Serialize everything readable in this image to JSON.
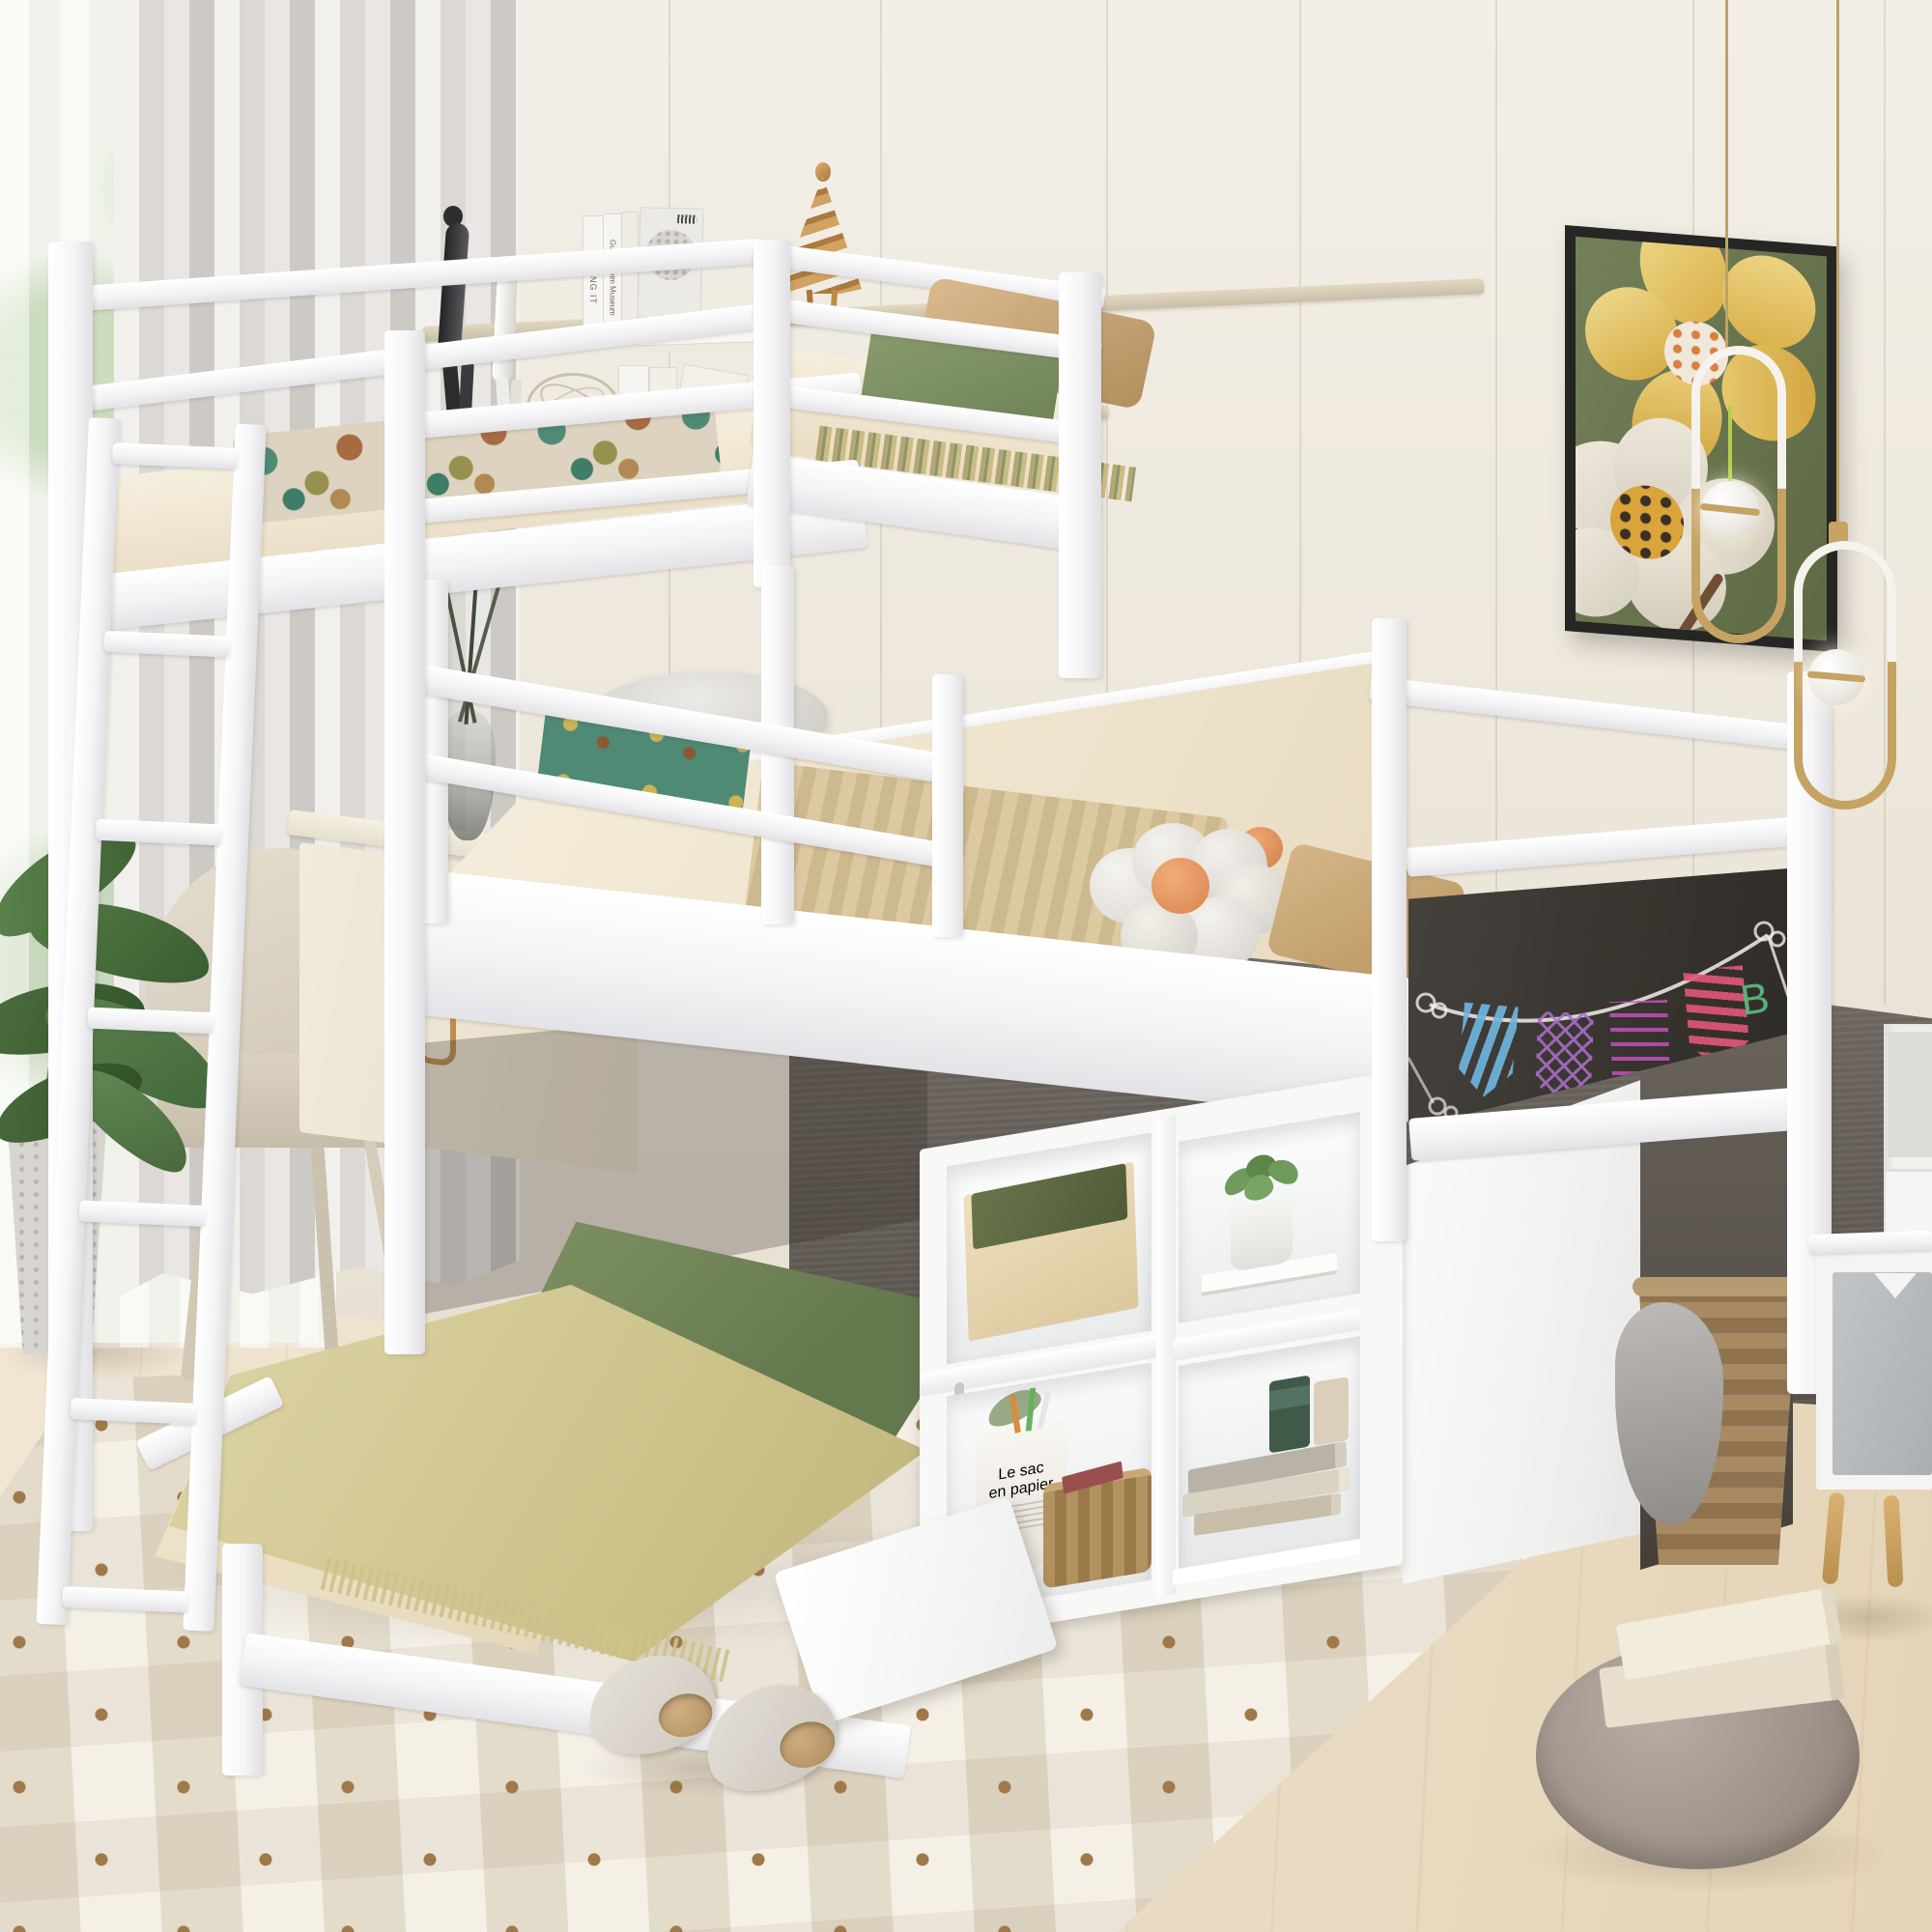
{
  "scene": {
    "type": "furniture product photograph",
    "subject": "White wood L-shaped triple bunk bed (twin-over-twin-over-twin) with ladder, storage cubby shelves, chalkboard panel, drop-down desk panel and under-loft nook",
    "room": "kids bedroom with cream panel walls, gray wood wainscot, light wood floor and patterned rug"
  },
  "texts": {
    "making_it": "MAKING IT",
    "guggenheim": "Guggenheim Museum",
    "lower_book": "IT",
    "bucket_line1": "Le sac",
    "bucket_line2": "en papier",
    "chalk_letter": "B"
  },
  "palette": {
    "bed_frame_white": "#fbfbfc",
    "wall_cream": "#efeae0",
    "wainscot_gray": "#6b655e",
    "floor_wood": "#ead9c0",
    "rug_beige": "#eae3d4",
    "rug_diamond_brown": "#a0794a",
    "mattress_cream": "#f3ebd9",
    "blanket_green": "#6d8157",
    "throw_yellow_green": "#d5cd9c",
    "pillow_tan": "#cdab7e",
    "flower_pillow_center_orange": "#e89a64",
    "chalkboard_dark": "#3c3935",
    "chalk_blue": "#6fb3dd",
    "chalk_purple": "#aa6ec8",
    "chalk_magenta": "#c850be",
    "chalk_pink": "#e05577",
    "chalk_green": "#5dbd82",
    "painting_bg_green": "#6e7b53",
    "painting_flower_yellow": "#e2bd5e",
    "pendant_gold": "#c2a06a",
    "curtain_gray_white": "#e6e3e0",
    "pouf_gray": "#a79b92",
    "nightstand_door_gray": "#b7babd",
    "wicker_tan": "#a98a5f"
  },
  "objects": [
    {
      "label": "triple bunk bed frame, white wood"
    },
    {
      "label": "top bunk with cream bedding, patterned blanket, green blanket, two tan pillows"
    },
    {
      "label": "middle loft bed with woven tan blanket, teal cloth, flower-shaped pillow with orange center, tan pillows"
    },
    {
      "label": "bottom bed with beige sheet, dark green blanket, fringed yellow-green throw"
    },
    {
      "label": "white ladder with seven rungs"
    },
    {
      "label": "chalkboard side panel with chalk banner garland drawing"
    },
    {
      "label": "storage cubbies with box, fabric bucket, wicker basket, succulent, books, candles"
    },
    {
      "label": "drop-down white desk panel"
    },
    {
      "label": "under-loft nook with wicker laundry basket and gray cloth"
    },
    {
      "label": "wall shelf with books, black and white sitting figurines, bronze spiral figurine, wire ball"
    },
    {
      "label": "framed painting of yellow and white flowers on green"
    },
    {
      "label": "two gold paperclip pendant lights with white globes"
    },
    {
      "label": "desk with glass vase and beige upholstered chair"
    },
    {
      "label": "white round stool"
    },
    {
      "label": "sheer window, long gray-white curtains, potted plant"
    },
    {
      "label": "white nightstand with gray door and wood legs"
    },
    {
      "label": "gray round floor pouf with two cream books"
    },
    {
      "label": "pair of white slippers on dotted rug"
    }
  ]
}
